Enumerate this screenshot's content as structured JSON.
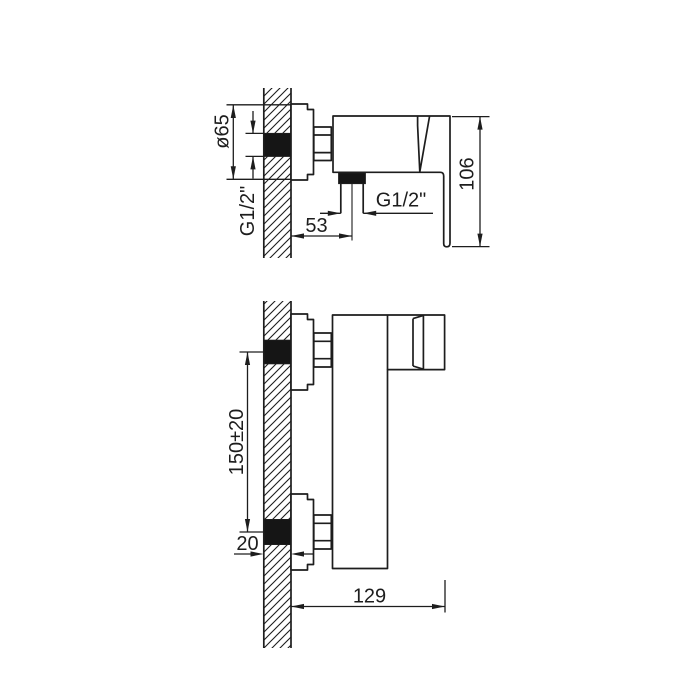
{
  "colors": {
    "ink": "#1d1d1d",
    "paper": "#ffffff",
    "seal_fill": "#151515"
  },
  "side_view": {
    "dims": {
      "flange_diameter": "ø65",
      "inlet_thread": "G1/2\"",
      "outlet_offset": "53",
      "outlet_thread": "G1/2\"",
      "height": "106"
    }
  },
  "front_view": {
    "dims": {
      "connection_spacing": "150±20",
      "eccentric_depth": "20",
      "overall_depth": "129"
    }
  }
}
